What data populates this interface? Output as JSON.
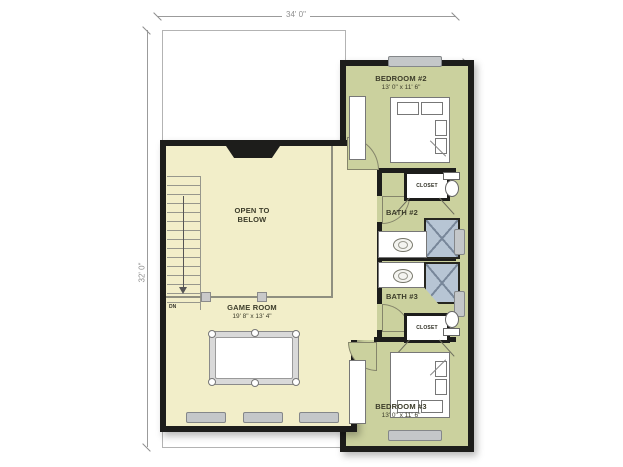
{
  "dimensions": {
    "width_top": "34' 0\"",
    "height_left": "32' 0\"",
    "height_right": "34' 8\""
  },
  "rooms": {
    "game_room": {
      "name": "GAME ROOM",
      "size": "19' 8\" x 13' 4\""
    },
    "open_to_below": {
      "name": "OPEN TO BELOW"
    },
    "bedroom2": {
      "name": "BEDROOM #2",
      "size": "13' 0\" x 11' 6\""
    },
    "bedroom3": {
      "name": "BEDROOM #3",
      "size": "13' 0\" x 11' 6\""
    },
    "bath2": {
      "name": "BATH #2"
    },
    "bath3": {
      "name": "BATH #3"
    },
    "closet_bath2": {
      "name": "CLOSET"
    },
    "closet_bath3": {
      "name": "CLOSET"
    },
    "stairs": {
      "direction_label": "DN"
    }
  },
  "colors": {
    "room_cream": "#f2eec9",
    "room_green": "#cbd19e",
    "wall": "#1d1d1b",
    "window_fill": "#c4c7c9",
    "shower_fill": "#b7c5d4",
    "dimension_gray": "#9b9b9b",
    "label_text": "#3c3c2a"
  }
}
